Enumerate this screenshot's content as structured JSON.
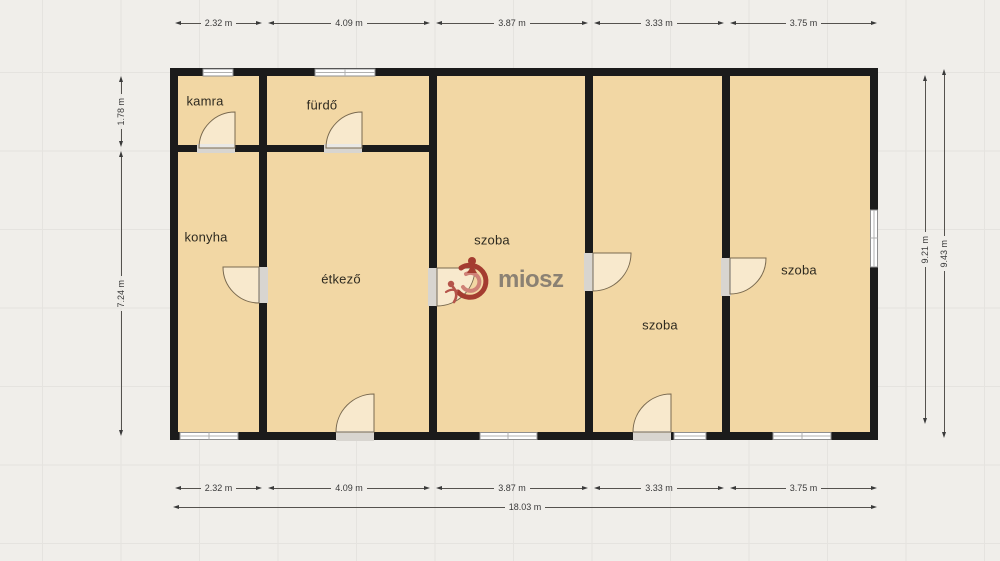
{
  "rooms": [
    {
      "id": "kamra",
      "label": "kamra"
    },
    {
      "id": "furdo",
      "label": "fürdő"
    },
    {
      "id": "konyha",
      "label": "konyha"
    },
    {
      "id": "etkezo",
      "label": "étkező"
    },
    {
      "id": "szoba-1",
      "label": "szoba"
    },
    {
      "id": "szoba-2",
      "label": "szoba"
    },
    {
      "id": "szoba-3",
      "label": "szoba"
    }
  ],
  "dimensions": {
    "top": [
      "2.32 m",
      "4.09 m",
      "3.87 m",
      "3.33 m",
      "3.75 m"
    ],
    "bottom": [
      "2.32 m",
      "4.09 m",
      "3.87 m",
      "3.33 m",
      "3.75 m"
    ],
    "bottom_total": "18.03 m",
    "left": [
      "1.78 m",
      "7.24 m"
    ],
    "right": [
      "9.21 m",
      "9.43 m"
    ]
  },
  "watermark": {
    "brand": "miosz"
  },
  "colors": {
    "background": "#f0eeea",
    "room_fill": "#f2d7a4",
    "wall": "#1b1b1b",
    "door_gap": "#d8d5d0",
    "logo_red": "#a43c30",
    "logo_salmon": "#cf8177",
    "logo_text": "#8b8173"
  }
}
